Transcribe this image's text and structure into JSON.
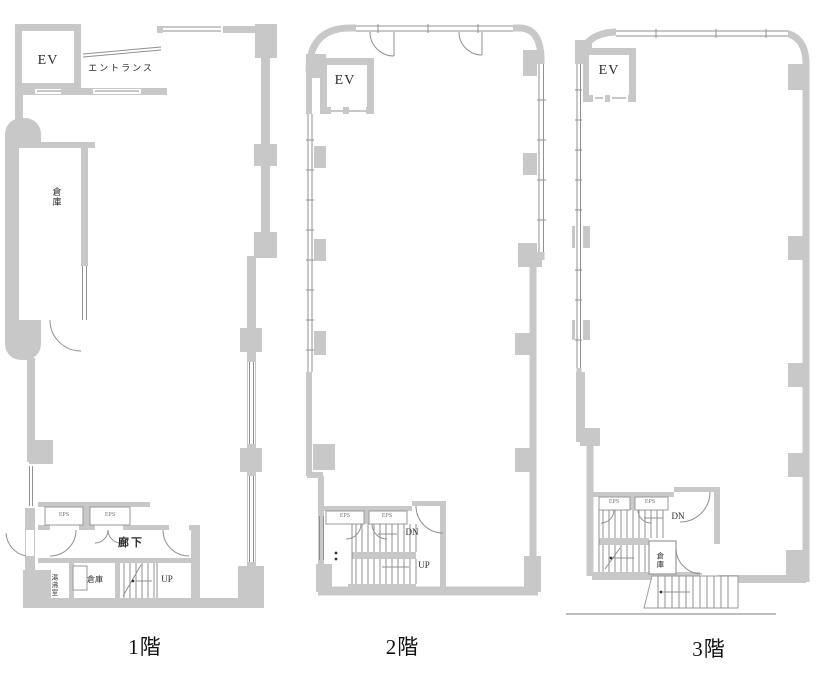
{
  "colors": {
    "wall": "#c8c8c8",
    "line": "#909090",
    "ink": "#2b2b2b",
    "ground": "#bdbdbd"
  },
  "floors": [
    {
      "caption": "1階",
      "labels": {
        "ev": "EV",
        "entrance": "エントランス",
        "storage_side": "倉庫",
        "eps_left": "EPS",
        "eps_right": "EPS",
        "corridor": "廊下",
        "kitchenette": "湯沸室",
        "storage": "倉庫",
        "up": "UP"
      }
    },
    {
      "caption": "2階",
      "labels": {
        "ev": "EV",
        "eps_left": "EPS",
        "eps_right": "EPS",
        "down": "DN",
        "up": "UP"
      }
    },
    {
      "caption": "3階",
      "labels": {
        "ev": "EV",
        "eps_left": "EPS",
        "eps_right": "EPS",
        "down": "DN",
        "storage": "倉庫"
      }
    }
  ]
}
